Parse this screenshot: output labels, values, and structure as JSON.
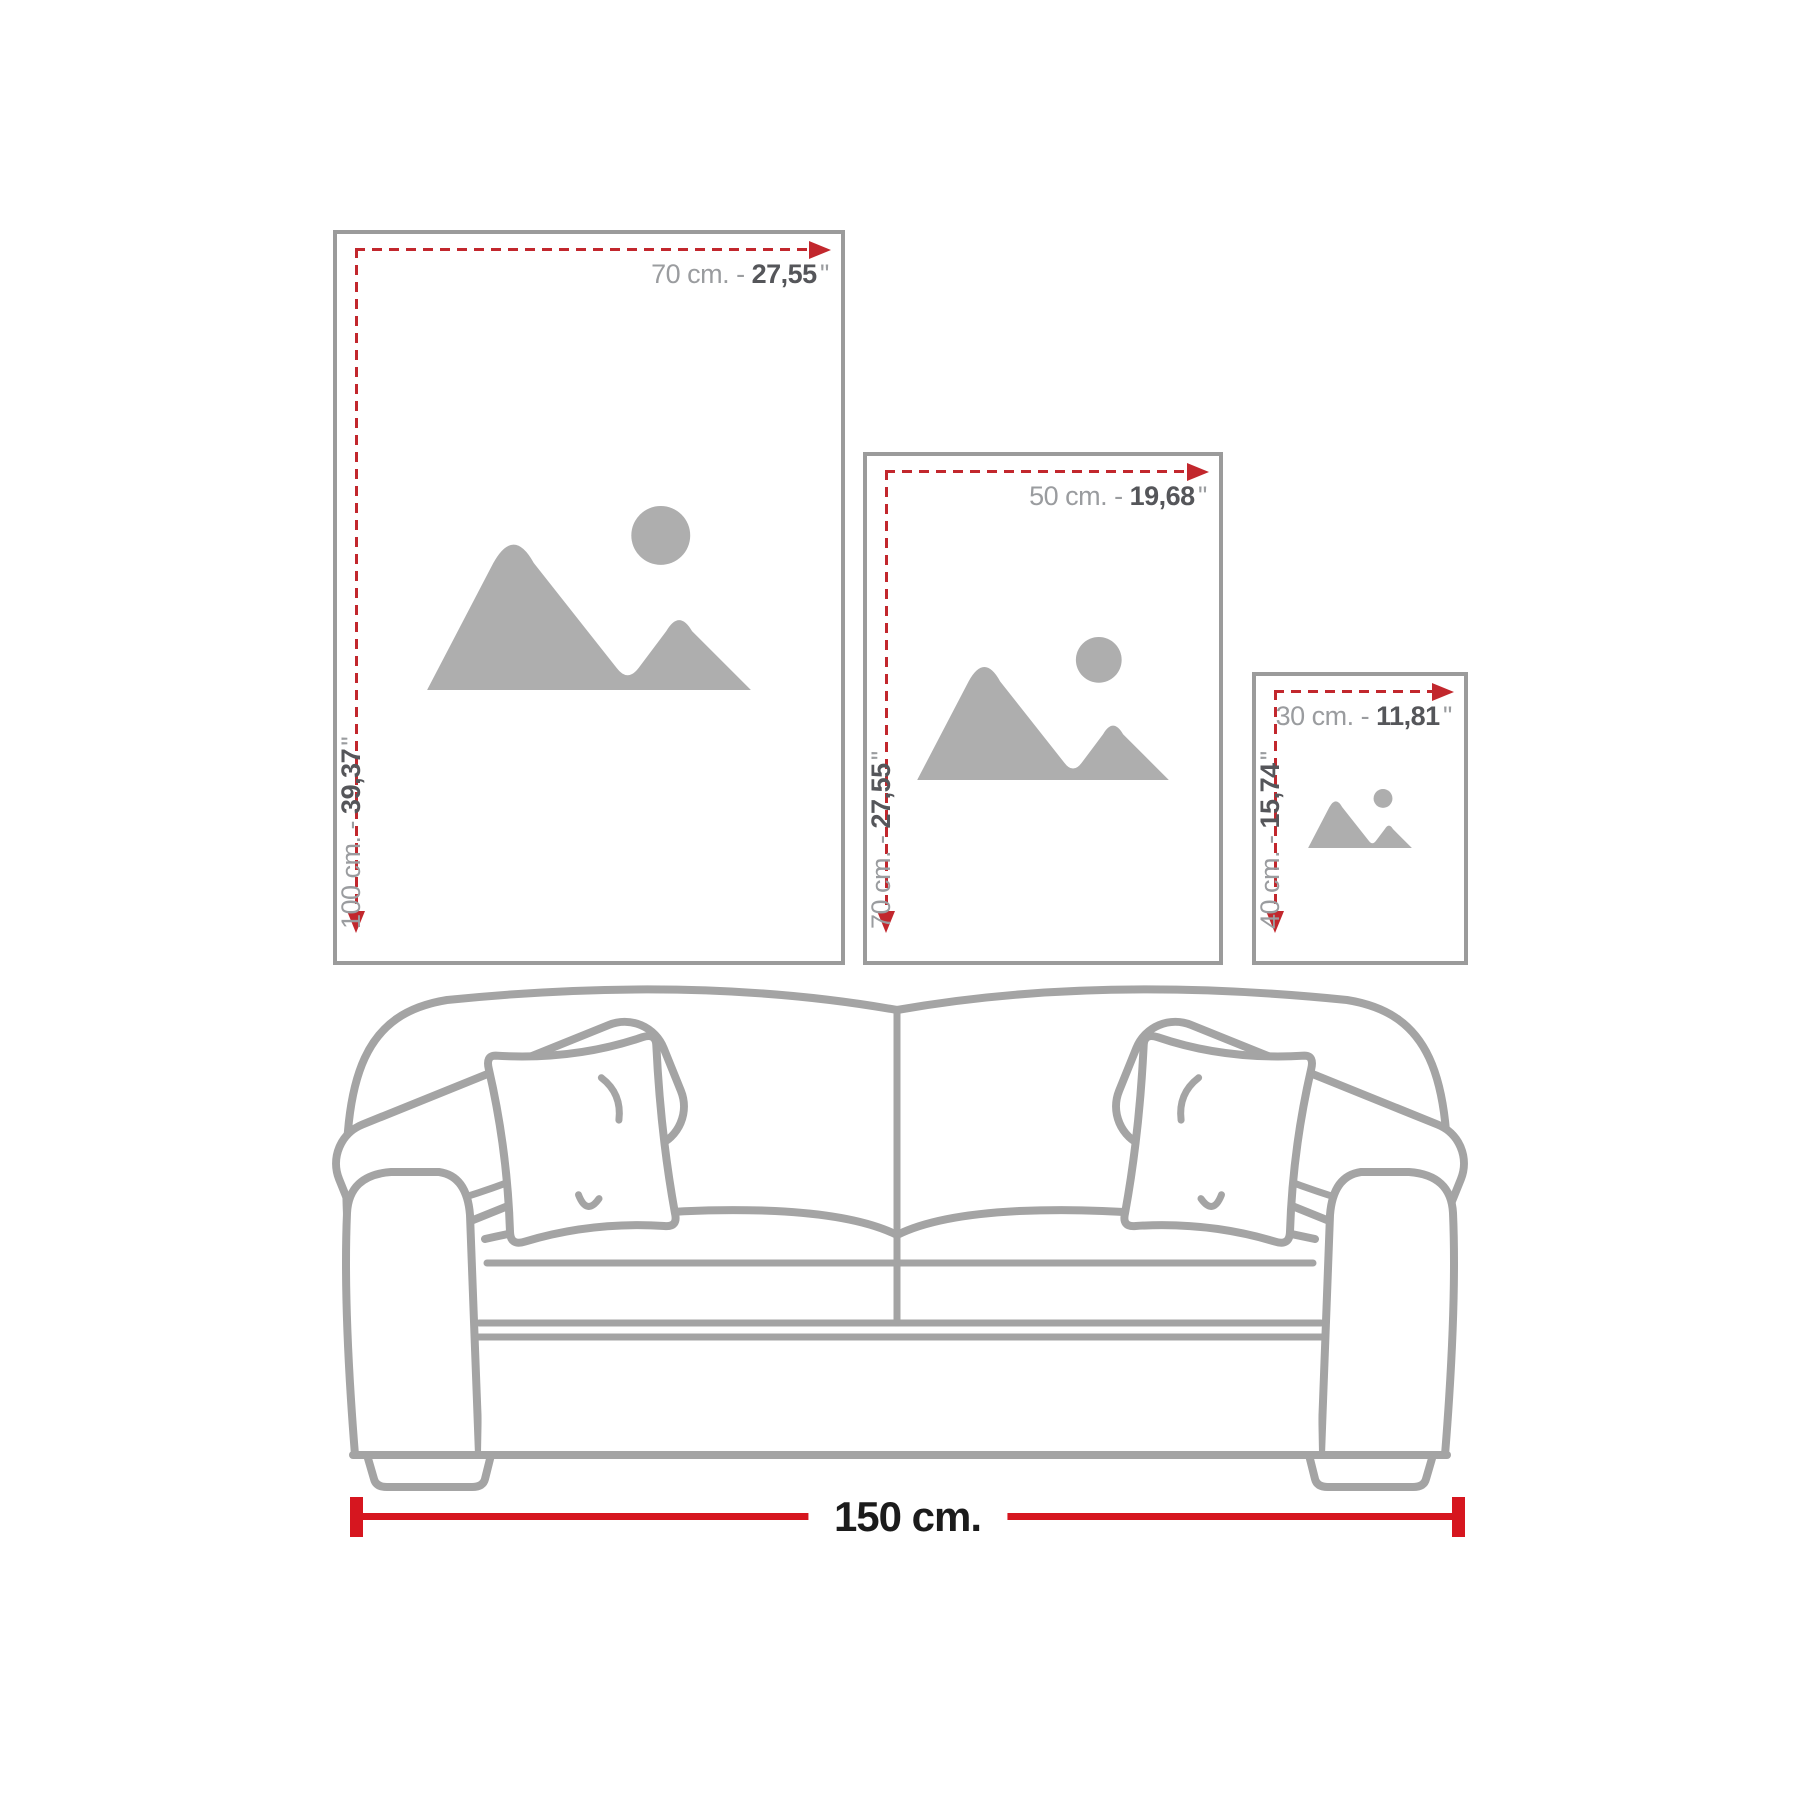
{
  "colors": {
    "frame_border": "#9b9b9b",
    "icon_gray": "#aeaeae",
    "dash_red": "#c2272d",
    "bar_red": "#d6161f",
    "label_gray": "#9a9c9f",
    "label_dark": "#55565a",
    "sofa_line": "#a4a4a4",
    "bar_text": "#1b1b1b"
  },
  "frames": [
    {
      "size": "large",
      "width_cm": "70 cm. - ",
      "width_in": "27,55",
      "width_unit": "''",
      "height_cm": "100 cm. - ",
      "height_in": "39,37",
      "height_unit": "''"
    },
    {
      "size": "medium",
      "width_cm": "50 cm. - ",
      "width_in": "19,68",
      "width_unit": "''",
      "height_cm": "70 cm. - ",
      "height_in": "27,55",
      "height_unit": "''"
    },
    {
      "size": "small",
      "width_cm": "30 cm. - ",
      "width_in": "11,81",
      "width_unit": "''",
      "height_cm": "40 cm. - ",
      "height_in": "15,74",
      "height_unit": "''"
    }
  ],
  "ruler": {
    "label": "150 cm."
  },
  "icons": {
    "placeholder": "image-placeholder-icon",
    "arrow_right": "arrow-right-icon",
    "arrow_down": "arrow-down-icon",
    "sofa": "sofa-outline-illustration"
  }
}
